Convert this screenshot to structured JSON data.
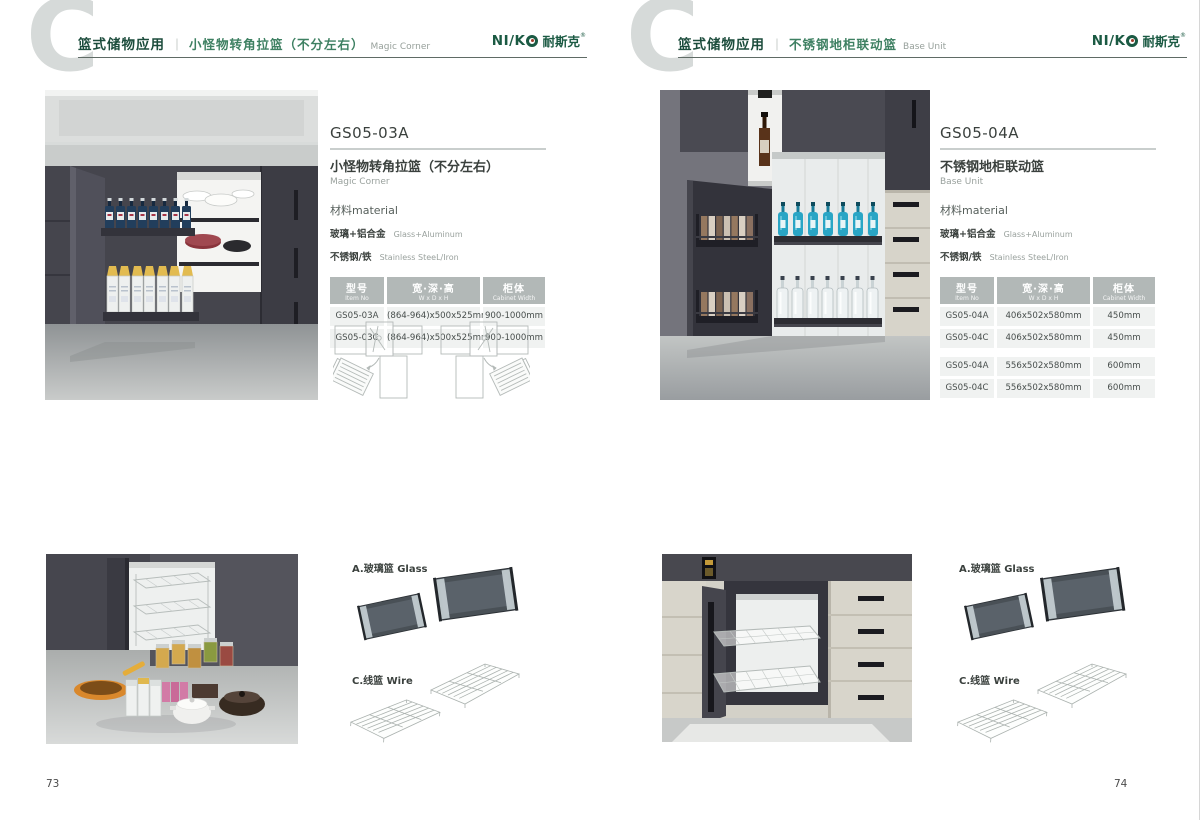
{
  "brand": {
    "logo_latin": "NI/K",
    "logo_cn": "耐斯克",
    "logo_reg": "®"
  },
  "colors": {
    "brand_green": "#1b5a43",
    "category_green": "#1c4c3c",
    "title_green": "#3e8062",
    "table_header_bg": "#b2b8b7",
    "table_row_bg": "#f0f2f1",
    "big_letter_gray": "#d6dad9"
  },
  "pages": [
    {
      "page_number": "73",
      "header": {
        "big_letter": "C",
        "category": "篮式储物应用",
        "divider": "｜",
        "title_cn": "小怪物转角拉篮（不分左右）",
        "title_en": "Magic Corner"
      },
      "product": {
        "model": "GS05-03A",
        "name_cn": "小怪物转角拉篮（不分左右）",
        "name_en": "Magic Corner",
        "material_label": "材料material",
        "materials": [
          {
            "cn": "玻璃+铝合金",
            "en": "Glass+Aluminum"
          },
          {
            "cn": "不锈钢/铁",
            "en": "Stainless SteeL/Iron"
          }
        ],
        "table": {
          "headers": [
            {
              "cn": "型号",
              "en": "Item No"
            },
            {
              "cn": "宽·深·高",
              "en": "W x D x H"
            },
            {
              "cn": "柜体",
              "en": "Cabinet Width"
            }
          ],
          "rows": [
            [
              "GS05-03A",
              "(864-964)x500x525mm",
              "900-1000mm"
            ],
            [
              "GS05-03C",
              "(864-964)x500x525mm",
              "900-1000mm"
            ]
          ]
        }
      },
      "accessories": {
        "glass_label": "A.玻璃篮 Glass",
        "wire_label": "C.线篮 Wire"
      }
    },
    {
      "page_number": "74",
      "header": {
        "big_letter": "C",
        "category": "篮式储物应用",
        "divider": "｜",
        "title_cn": "不锈钢地柜联动篮",
        "title_en": "Base Unit"
      },
      "product": {
        "model": "GS05-04A",
        "name_cn": "不锈钢地柜联动篮",
        "name_en": "Base Unit",
        "material_label": "材料material",
        "materials": [
          {
            "cn": "玻璃+铝合金",
            "en": "Glass+Aluminum"
          },
          {
            "cn": "不锈钢/铁",
            "en": "Stainless SteeL/Iron"
          }
        ],
        "table": {
          "headers": [
            {
              "cn": "型号",
              "en": "Item No"
            },
            {
              "cn": "宽·深·高",
              "en": "W x D x H"
            },
            {
              "cn": "柜体",
              "en": "Cabinet Width"
            }
          ],
          "rows": [
            [
              "GS05-04A",
              "406x502x580mm",
              "450mm"
            ],
            [
              "GS05-04C",
              "406x502x580mm",
              "450mm"
            ],
            [
              "GS05-04A",
              "556x502x580mm",
              "600mm"
            ],
            [
              "GS05-04C",
              "556x502x580mm",
              "600mm"
            ]
          ]
        }
      },
      "accessories": {
        "glass_label": "A.玻璃篮 Glass",
        "wire_label": "C.线篮 Wire"
      }
    }
  ]
}
